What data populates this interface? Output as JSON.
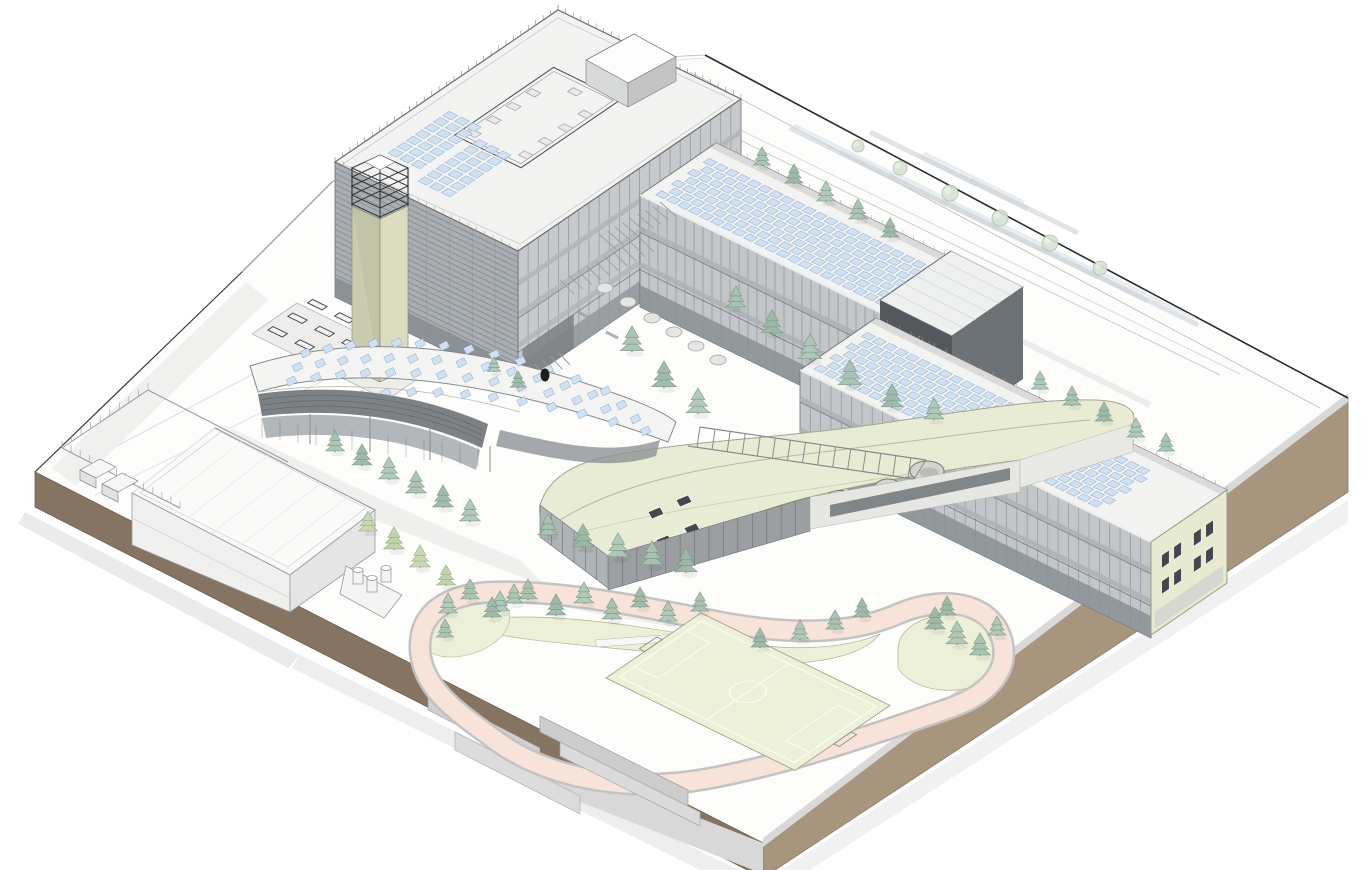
{
  "meta": {
    "title": "Architectural axonometric site rendering of a school campus with photovoltaic roofs, green roof hall, running track and sports field",
    "visible_text": "none"
  },
  "palette": {
    "ground": "#fdfdfc",
    "earth_dark": "#867462",
    "earth_light": "#a8957e",
    "curb": "#d9d9d9",
    "roof_white": "#f3f4f2",
    "facade_glass": "#c6cacd",
    "facade_louver": "#a9aeb2",
    "facade_dark": "#54585c",
    "facade_mid": "#6d7276",
    "tower": "#c9ccad",
    "tower_light": "#dadcc0",
    "cream": "#e8e9d1",
    "green_roof": "#e9ecd5",
    "lawn": "#edf0d8",
    "field": "#eef1da",
    "track": "#f7e3d9",
    "track_edge": "#c3c3c3",
    "panel": "#cfe1f3",
    "panel_stroke": "#89a3c0",
    "tree_fills": [
      "#a9c3b2",
      "#9db9a8",
      "#b0c9ba"
    ],
    "tree_stroke": "#7d9a89",
    "tree_yellow": "#c9d8b4",
    "tree_light": "#d7e3d4",
    "line": "#777777"
  },
  "components": [
    {
      "name": "main-building",
      "label": "4-storey main building with rooftop terrace, penthouse and PV arrays"
    },
    {
      "name": "stair-tower",
      "label": "khaki stair/lift tower with roof railing cage"
    },
    {
      "name": "classroom-wing-north",
      "label": "3-storey classroom wing with rooftop PV rows"
    },
    {
      "name": "link-box",
      "label": "dark connector volume between wings"
    },
    {
      "name": "classroom-wing-south",
      "label": "3-storey classroom wing with cream gable and PV rows"
    },
    {
      "name": "curved-canopy-building",
      "label": "curved low building with PV rows on curved roof"
    },
    {
      "name": "green-roof-hall",
      "label": "free-form green-roof hall with skylights and round openings"
    },
    {
      "name": "service-warehouse",
      "label": "flat-roof service hall with tank yard and fenced enclosure"
    },
    {
      "name": "bench-terrace",
      "label": "terrace with benches"
    },
    {
      "name": "track-and-field",
      "label": "running track loop, soccer field, lawns and tree mounds"
    },
    {
      "name": "site-plinth",
      "label": "site base with earth-toned section faces"
    }
  ],
  "scene": {
    "trees_conifer": [
      [
        632,
        352,
        26
      ],
      [
        664,
        388,
        27
      ],
      [
        698,
        414,
        26
      ],
      [
        736,
        308,
        22
      ],
      [
        772,
        334,
        24
      ],
      [
        810,
        360,
        26
      ],
      [
        850,
        386,
        26
      ],
      [
        892,
        408,
        24
      ],
      [
        934,
        420,
        22
      ],
      [
        335,
        452,
        21
      ],
      [
        362,
        466,
        22
      ],
      [
        389,
        480,
        23
      ],
      [
        416,
        494,
        23
      ],
      [
        443,
        508,
        23
      ],
      [
        470,
        522,
        23
      ],
      [
        548,
        536,
        22
      ],
      [
        583,
        548,
        24
      ],
      [
        618,
        558,
        25
      ],
      [
        652,
        566,
        25
      ],
      [
        686,
        573,
        25
      ],
      [
        500,
        612,
        21
      ],
      [
        528,
        600,
        21
      ],
      [
        556,
        616,
        22
      ],
      [
        584,
        604,
        22
      ],
      [
        612,
        620,
        22
      ],
      [
        640,
        608,
        21
      ],
      [
        668,
        622,
        21
      ],
      [
        700,
        612,
        20
      ],
      [
        760,
        648,
        20
      ],
      [
        800,
        640,
        20
      ],
      [
        835,
        630,
        20
      ],
      [
        862,
        618,
        20
      ],
      [
        448,
        614,
        21
      ],
      [
        470,
        600,
        21
      ],
      [
        492,
        618,
        21
      ],
      [
        514,
        604,
        20
      ],
      [
        445,
        638,
        19
      ],
      [
        935,
        630,
        23
      ],
      [
        957,
        645,
        24
      ],
      [
        980,
        656,
        23
      ],
      [
        947,
        616,
        20
      ],
      [
        997,
        636,
        20
      ],
      [
        762,
        166,
        19
      ],
      [
        794,
        184,
        20
      ],
      [
        826,
        202,
        21
      ],
      [
        858,
        220,
        21
      ],
      [
        890,
        238,
        20
      ],
      [
        1040,
        390,
        19
      ],
      [
        1072,
        406,
        20
      ],
      [
        1104,
        422,
        20
      ],
      [
        1136,
        438,
        20
      ],
      [
        1166,
        452,
        19
      ],
      [
        518,
        388,
        17
      ],
      [
        494,
        372,
        15
      ]
    ],
    "trees_yellow": [
      [
        368,
        532,
        21
      ],
      [
        394,
        550,
        23
      ],
      [
        420,
        568,
        23
      ],
      [
        446,
        586,
        21
      ]
    ],
    "trees_light": [
      [
        900,
        168,
        7
      ],
      [
        950,
        193,
        8
      ],
      [
        1000,
        218,
        8
      ],
      [
        1050,
        243,
        8
      ],
      [
        1100,
        268,
        7
      ],
      [
        858,
        146,
        6
      ]
    ],
    "shrubs": [
      [
        652,
        318
      ],
      [
        674,
        332
      ],
      [
        696,
        346
      ],
      [
        718,
        360
      ],
      [
        628,
        302
      ],
      [
        605,
        288
      ]
    ],
    "benches": {
      "origin": [
        268,
        330
      ],
      "rows": 3,
      "cols": 3,
      "du": 30,
      "dv": 24,
      "w": 16,
      "h": 6
    },
    "panels_main": [
      {
        "origin": [
          335,
          162
        ],
        "u0": 26,
        "v0": 36,
        "rows": 3,
        "cols": 7,
        "du": 13,
        "dv": 11,
        "w": 9.5,
        "h": 8
      },
      {
        "origin": [
          335,
          162
        ],
        "u0": 72,
        "v0": 22,
        "rows": 3,
        "cols": 7,
        "du": 13,
        "dv": 11,
        "w": 9.5,
        "h": 8
      }
    ],
    "panels_wings": [
      {
        "origin": [
          640,
          195
        ],
        "u0": 10,
        "v0": 8,
        "rows": 7,
        "cols": 22,
        "du": 12.2,
        "dv": 9.6,
        "w": 9,
        "h": 7.2,
        "stagger": 6
      },
      {
        "origin": [
          800,
          370
        ],
        "u0": 8,
        "v0": 8,
        "rows": 7,
        "cols": 26,
        "du": 12.2,
        "dv": 9.6,
        "w": 9,
        "h": 7.2,
        "stagger": 6
      }
    ],
    "panels_curved": [
      {
        "p": [
          [
            300,
            352
          ],
          [
            390,
            332
          ],
          [
            480,
            340
          ],
          [
            600,
            390
          ]
        ],
        "n": 13
      },
      {
        "p": [
          [
            292,
            366
          ],
          [
            390,
            348
          ],
          [
            490,
            356
          ],
          [
            616,
            404
          ]
        ],
        "n": 14
      },
      {
        "p": [
          [
            286,
            380
          ],
          [
            392,
            362
          ],
          [
            500,
            372
          ],
          [
            630,
            418
          ]
        ],
        "n": 14
      },
      {
        "p": [
          [
            330,
            398
          ],
          [
            420,
            382
          ],
          [
            520,
            394
          ],
          [
            640,
            430
          ]
        ],
        "n": 12
      }
    ],
    "ne_canopy_strips": [
      [
        790,
        128
      ],
      [
        840,
        152
      ],
      [
        890,
        176
      ],
      [
        940,
        200
      ],
      [
        990,
        224
      ],
      [
        1040,
        248
      ],
      [
        1090,
        272
      ],
      [
        870,
        132
      ],
      [
        920,
        156
      ],
      [
        970,
        180
      ]
    ],
    "gable_window_cols": [
      0.14,
      0.3,
      0.56,
      0.72
    ],
    "gable_window_rows": [
      0.22,
      0.5
    ],
    "tanks": [
      [
        358,
        584
      ],
      [
        372,
        592
      ],
      [
        386,
        582
      ]
    ],
    "figure": [
      545,
      375
    ],
    "counts": {
      "pv_rows_wing_north": 7,
      "pv_rows_wing_south": 7,
      "round_roof_openings": 3,
      "roof_skylights": 4
    }
  }
}
